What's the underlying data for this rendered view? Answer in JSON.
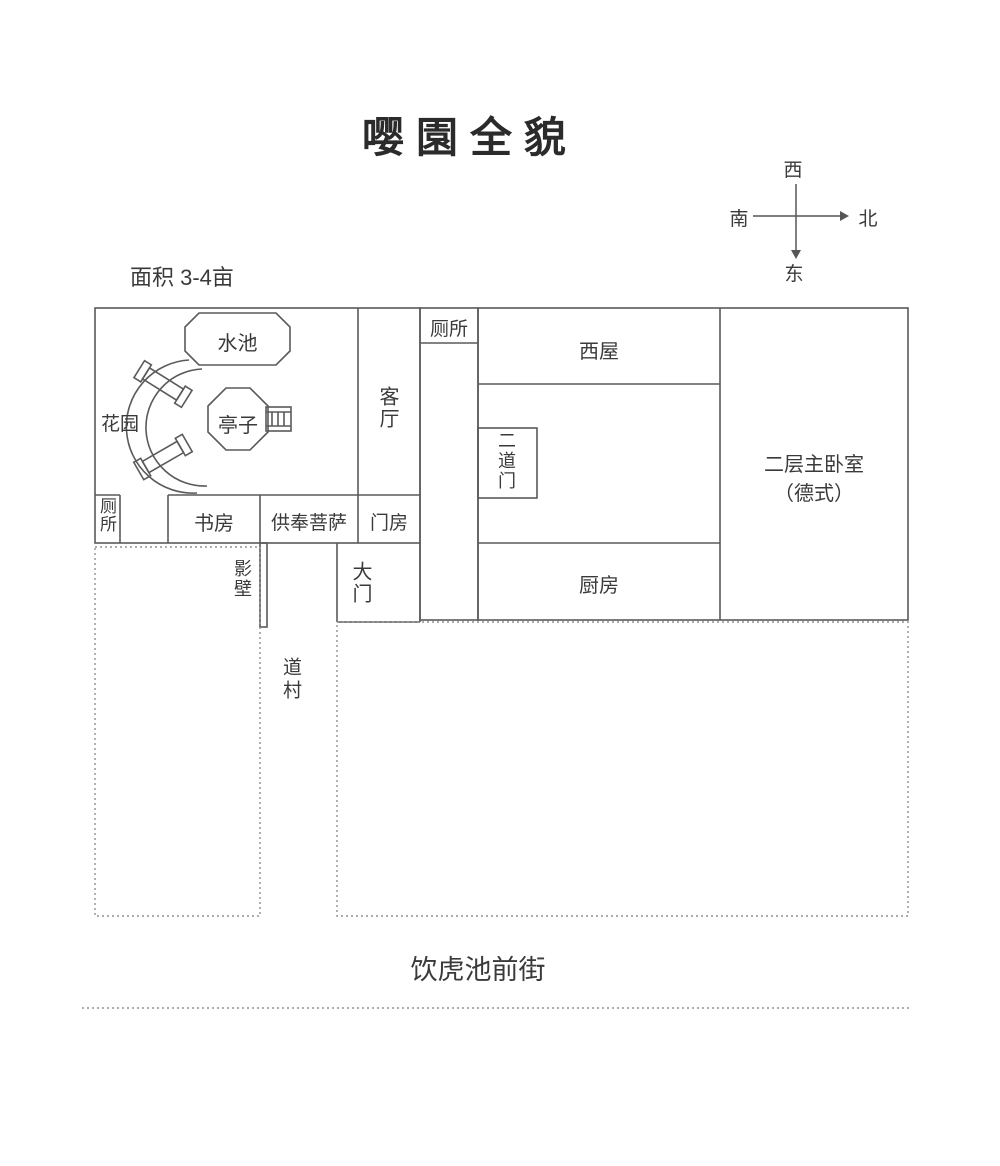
{
  "title": "嘤園全貌",
  "area_label": "面积 3-4亩",
  "compass": {
    "west": "西",
    "south": "南",
    "north": "北",
    "east": "东"
  },
  "plan": {
    "garden": "花园",
    "pool": "水池",
    "pavilion": "亭子",
    "living_room": "客厅",
    "corridor_toilet": "厕所",
    "corner_toilet": "厕所",
    "west_room": "西屋",
    "second_gate": "二道门",
    "master_bedroom": "二层主卧室",
    "master_bedroom_note": "（德式）",
    "study": "书房",
    "bodhisattva_shrine": "供奉菩萨",
    "gate_house": "门房",
    "screen_wall": "影壁",
    "main_gate": "大门",
    "kitchen": "厨房",
    "lane": "道村",
    "street": "饮虎池前街"
  },
  "colors": {
    "wall": "#5a5a5a",
    "dotted_line": "#909090",
    "text": "#3a3a3a",
    "title": "#2b2b2b",
    "background": "#ffffff"
  }
}
